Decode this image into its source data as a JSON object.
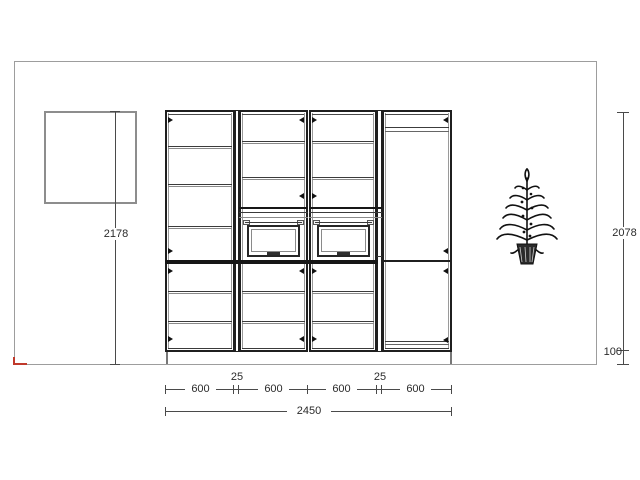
{
  "dimensions": {
    "left_total_height": "2178",
    "body_height": "2078",
    "plinth_height": "100",
    "bottom_segments": [
      "600",
      "25",
      "600",
      "600",
      "25",
      "600"
    ],
    "total_width": "2450"
  },
  "icons": {
    "plant": "potted-plant",
    "door_swing": "door-hinge-arrow"
  },
  "colors": {
    "background": "#ffffff",
    "cabinet_line": "#1f1f1f",
    "wall_line": "#9d9d9d",
    "dimension_line": "#4a4a4a",
    "text": "#2b2b2b",
    "origin_marker": "#c0392b"
  }
}
